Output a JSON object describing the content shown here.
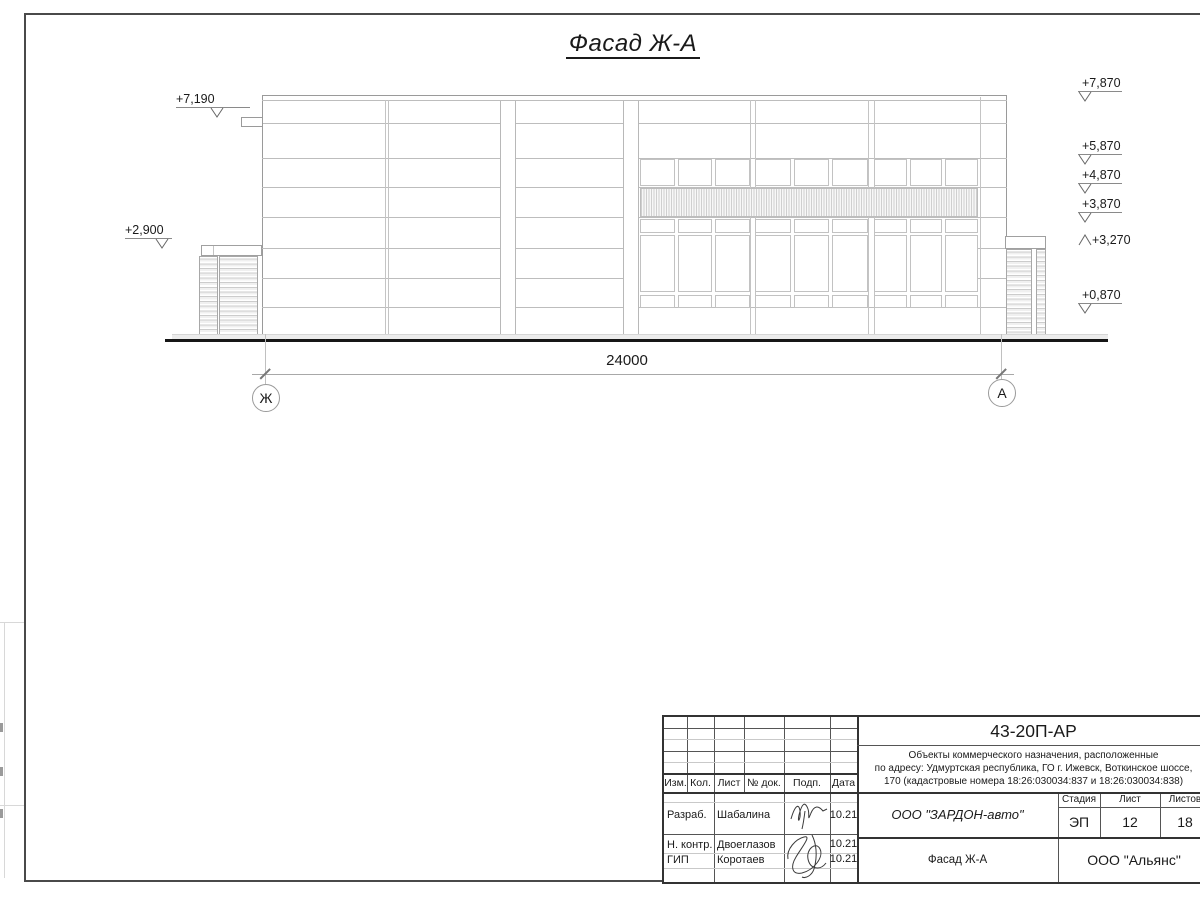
{
  "drawing_title": {
    "text": "Фасад Ж-А"
  },
  "elevation_marks": {
    "left": [
      {
        "label": "+7,190"
      },
      {
        "label": "+2,900"
      }
    ],
    "right": [
      {
        "label": "+7,870"
      },
      {
        "label": "+5,870"
      },
      {
        "label": "+4,870"
      },
      {
        "label": "+3,870"
      },
      {
        "label": "+3,270"
      },
      {
        "label": "+0,870"
      }
    ]
  },
  "dimension": {
    "value": "24000"
  },
  "axes": {
    "left": "Ж",
    "right": "А"
  },
  "title_block": {
    "doc_code": "43-20П-АР",
    "project_line1": "Объекты коммерческого назначения, расположенные",
    "project_line2": "по адресу: Удмуртская республика, ГО г. Ижевск, Воткинское шоссе,",
    "project_line3": "170 (кадастровые номера 18:26:030034:837 и 18:26:030034:838)",
    "header": {
      "izm": "Изм.",
      "kol": "Кол.",
      "list": "Лист",
      "ndok": "№ док.",
      "podp": "Подп.",
      "data": "Дата"
    },
    "rows": [
      {
        "role": "Разраб.",
        "name": "Шабалина",
        "date": "10.21"
      },
      {
        "role": "Н. контр.",
        "name": "Двоеглазов",
        "date": "10.21"
      },
      {
        "role": "ГИП",
        "name": "Коротаев",
        "date": "10.21"
      }
    ],
    "client": "ООО \"ЗАРДОН-авто\"",
    "stage_header": {
      "stage": "Стадия",
      "sheet": "Лист",
      "sheets": "Листов"
    },
    "stage_values": {
      "stage": "ЭП",
      "sheet": "12",
      "sheets": "18"
    },
    "sheet_title": "Фасад Ж-А",
    "organization": "ООО \"Альянс\""
  },
  "colors": {
    "frame": "#4a4a4a",
    "drawing_line": "#bdbdbd",
    "ground": "#161616",
    "text": "#1a1a1a"
  }
}
